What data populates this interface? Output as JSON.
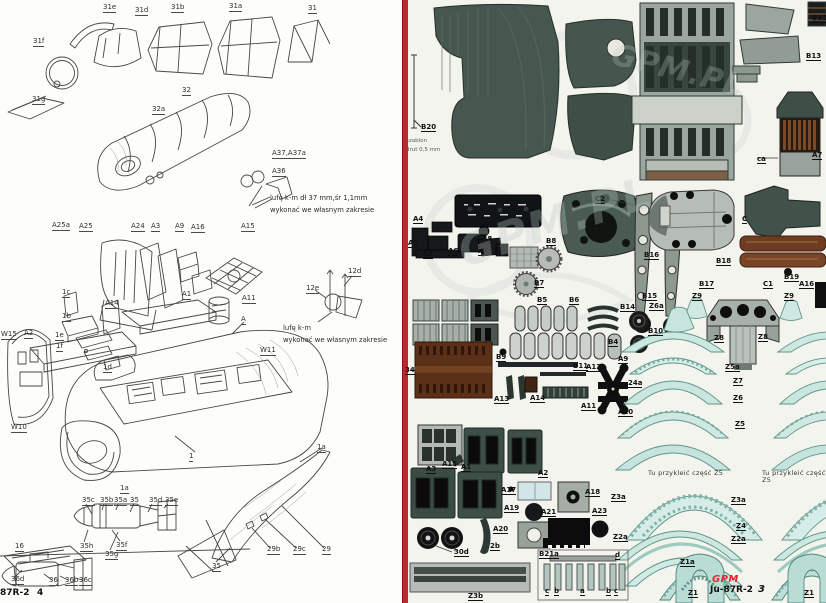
{
  "document": {
    "publisher": "GPM",
    "model": "Ju-87R-2",
    "left_page_number": "4",
    "right_page_number": "3",
    "watermark": "GPM.PL"
  },
  "colors": {
    "divider_red": "#c1272d",
    "dark_green_skin": "#44564e",
    "grey_green_part": "#96a49c",
    "teal_band": "#cde8e1",
    "teal_edge": "#5e9488",
    "brown_part": "#6e3c21",
    "black_part": "#111111",
    "logo_red": "#e02b30"
  },
  "left_labels": [
    {
      "t": "31f",
      "x": 33,
      "y": 38
    },
    {
      "t": "31e",
      "x": 103,
      "y": 4
    },
    {
      "t": "31d",
      "x": 135,
      "y": 7
    },
    {
      "t": "31b",
      "x": 171,
      "y": 4
    },
    {
      "t": "31a",
      "x": 229,
      "y": 3
    },
    {
      "t": "31",
      "x": 308,
      "y": 5
    },
    {
      "t": "31g",
      "x": 32,
      "y": 96
    },
    {
      "t": "32",
      "x": 182,
      "y": 87
    },
    {
      "t": "32a",
      "x": 152,
      "y": 106
    },
    {
      "t": "A37,A37a",
      "x": 272,
      "y": 150
    },
    {
      "t": "A36",
      "x": 272,
      "y": 168
    },
    {
      "t": "A25a",
      "x": 52,
      "y": 222
    },
    {
      "t": "A25",
      "x": 79,
      "y": 223
    },
    {
      "t": "A24",
      "x": 131,
      "y": 223
    },
    {
      "t": "A3",
      "x": 151,
      "y": 223
    },
    {
      "t": "A9",
      "x": 175,
      "y": 223
    },
    {
      "t": "A16",
      "x": 191,
      "y": 224
    },
    {
      "t": "A15",
      "x": 241,
      "y": 223
    },
    {
      "t": "1c",
      "x": 62,
      "y": 289
    },
    {
      "t": "1b",
      "x": 62,
      "y": 313
    },
    {
      "t": "A14",
      "x": 105,
      "y": 300
    },
    {
      "t": "A1",
      "x": 182,
      "y": 291
    },
    {
      "t": "A11",
      "x": 242,
      "y": 295
    },
    {
      "t": "A",
      "x": 241,
      "y": 316
    },
    {
      "t": "12d",
      "x": 348,
      "y": 268
    },
    {
      "t": "12e",
      "x": 306,
      "y": 285
    },
    {
      "t": "W15",
      "x": 1,
      "y": 331
    },
    {
      "t": "A2",
      "x": 24,
      "y": 330
    },
    {
      "t": "1e",
      "x": 55,
      "y": 332
    },
    {
      "t": "1f",
      "x": 56,
      "y": 343
    },
    {
      "t": "1d",
      "x": 103,
      "y": 364
    },
    {
      "t": "W11",
      "x": 260,
      "y": 347
    },
    {
      "t": "W10",
      "x": 11,
      "y": 424
    },
    {
      "t": "1",
      "x": 189,
      "y": 453
    },
    {
      "t": "1a",
      "x": 120,
      "y": 485
    },
    {
      "t": "1a",
      "x": 317,
      "y": 444
    },
    {
      "t": "35c",
      "x": 82,
      "y": 497
    },
    {
      "t": "35b",
      "x": 100,
      "y": 497
    },
    {
      "t": "35a",
      "x": 114,
      "y": 497
    },
    {
      "t": "35",
      "x": 130,
      "y": 497
    },
    {
      "t": "35d",
      "x": 149,
      "y": 497
    },
    {
      "t": "35e",
      "x": 165,
      "y": 497
    },
    {
      "t": "16",
      "x": 15,
      "y": 543
    },
    {
      "t": "35h",
      "x": 80,
      "y": 543
    },
    {
      "t": "35f",
      "x": 116,
      "y": 542
    },
    {
      "t": "35g",
      "x": 105,
      "y": 551
    },
    {
      "t": "29b",
      "x": 267,
      "y": 546
    },
    {
      "t": "29c",
      "x": 293,
      "y": 546
    },
    {
      "t": "29",
      "x": 322,
      "y": 546
    },
    {
      "t": "35",
      "x": 212,
      "y": 563
    },
    {
      "t": "36d",
      "x": 11,
      "y": 576
    },
    {
      "t": "36",
      "x": 49,
      "y": 577
    },
    {
      "t": "36b",
      "x": 65,
      "y": 577
    },
    {
      "t": "36c",
      "x": 79,
      "y": 577
    }
  ],
  "right_labels": [
    {
      "t": "B20",
      "x": 421,
      "y": 124
    },
    {
      "t": "B12",
      "x": 812,
      "y": 15
    },
    {
      "t": "B13",
      "x": 806,
      "y": 53
    },
    {
      "t": "ca",
      "x": 757,
      "y": 156
    },
    {
      "t": "A7",
      "x": 812,
      "y": 152
    },
    {
      "t": "A4",
      "x": 413,
      "y": 216
    },
    {
      "t": "A5",
      "x": 408,
      "y": 240
    },
    {
      "t": "B1",
      "x": 423,
      "y": 251
    },
    {
      "t": "A6",
      "x": 448,
      "y": 248
    },
    {
      "t": "A7",
      "x": 478,
      "y": 248
    },
    {
      "t": "A8",
      "x": 482,
      "y": 236
    },
    {
      "t": "B3",
      "x": 496,
      "y": 247
    },
    {
      "t": "B8",
      "x": 546,
      "y": 238
    },
    {
      "t": "C2",
      "x": 595,
      "y": 196
    },
    {
      "t": "C",
      "x": 742,
      "y": 216
    },
    {
      "t": "B16",
      "x": 644,
      "y": 252
    },
    {
      "t": "B18",
      "x": 716,
      "y": 258
    },
    {
      "t": "B17",
      "x": 699,
      "y": 281
    },
    {
      "t": "B15",
      "x": 642,
      "y": 293
    },
    {
      "t": "B14",
      "x": 620,
      "y": 304
    },
    {
      "t": "B19",
      "x": 784,
      "y": 274
    },
    {
      "t": "C1",
      "x": 763,
      "y": 281
    },
    {
      "t": "A16",
      "x": 799,
      "y": 281
    },
    {
      "t": "Z9",
      "x": 692,
      "y": 293
    },
    {
      "t": "Z9",
      "x": 784,
      "y": 293
    },
    {
      "t": "Z6a",
      "x": 649,
      "y": 303
    },
    {
      "t": "B7",
      "x": 534,
      "y": 280
    },
    {
      "t": "B5",
      "x": 537,
      "y": 297
    },
    {
      "t": "B6",
      "x": 569,
      "y": 297
    },
    {
      "t": "B4",
      "x": 608,
      "y": 339
    },
    {
      "t": "34",
      "x": 405,
      "y": 367
    },
    {
      "t": "B9",
      "x": 496,
      "y": 354
    },
    {
      "t": "B11",
      "x": 573,
      "y": 363
    },
    {
      "t": "A12",
      "x": 586,
      "y": 364
    },
    {
      "t": "A13",
      "x": 494,
      "y": 396
    },
    {
      "t": "A14",
      "x": 530,
      "y": 395
    },
    {
      "t": "A11",
      "x": 581,
      "y": 403
    },
    {
      "t": "A9",
      "x": 618,
      "y": 356
    },
    {
      "t": "24a",
      "x": 628,
      "y": 380
    },
    {
      "t": "A10",
      "x": 618,
      "y": 409
    },
    {
      "t": "B10",
      "x": 648,
      "y": 328
    },
    {
      "t": "Z8",
      "x": 714,
      "y": 335
    },
    {
      "t": "Z8",
      "x": 758,
      "y": 334
    },
    {
      "t": "Z5a",
      "x": 725,
      "y": 364
    },
    {
      "t": "Z7",
      "x": 733,
      "y": 378
    },
    {
      "t": "Z6",
      "x": 733,
      "y": 395
    },
    {
      "t": "Z5",
      "x": 735,
      "y": 421
    },
    {
      "t": "Z3a",
      "x": 611,
      "y": 494
    },
    {
      "t": "Z2a",
      "x": 613,
      "y": 534
    },
    {
      "t": "Z3a",
      "x": 731,
      "y": 497
    },
    {
      "t": "Z4",
      "x": 736,
      "y": 523
    },
    {
      "t": "Z2a",
      "x": 731,
      "y": 536
    },
    {
      "t": "A3",
      "x": 426,
      "y": 466
    },
    {
      "t": "A15",
      "x": 442,
      "y": 461
    },
    {
      "t": "A1",
      "x": 461,
      "y": 464
    },
    {
      "t": "A2",
      "x": 538,
      "y": 470
    },
    {
      "t": "A17",
      "x": 501,
      "y": 487
    },
    {
      "t": "A18",
      "x": 585,
      "y": 489
    },
    {
      "t": "A19",
      "x": 504,
      "y": 505
    },
    {
      "t": "A20",
      "x": 493,
      "y": 526
    },
    {
      "t": "A21",
      "x": 541,
      "y": 509
    },
    {
      "t": "A23",
      "x": 592,
      "y": 508
    },
    {
      "t": "30d",
      "x": 454,
      "y": 549
    },
    {
      "t": "2b",
      "x": 490,
      "y": 543
    },
    {
      "t": "Z3b",
      "x": 468,
      "y": 593
    },
    {
      "t": "B21a",
      "x": 539,
      "y": 551
    },
    {
      "t": "d",
      "x": 615,
      "y": 552
    },
    {
      "t": "c",
      "x": 545,
      "y": 588
    },
    {
      "t": "b",
      "x": 554,
      "y": 588
    },
    {
      "t": "a",
      "x": 580,
      "y": 588
    },
    {
      "t": "b",
      "x": 606,
      "y": 588
    },
    {
      "t": "c",
      "x": 614,
      "y": 588
    },
    {
      "t": "Z1a",
      "x": 680,
      "y": 559
    },
    {
      "t": "Z1",
      "x": 688,
      "y": 590
    },
    {
      "t": "Z1",
      "x": 804,
      "y": 590
    }
  ],
  "texts": [
    {
      "t": "lufę k-m dł 37 mm,śr 1,1mm\nwykonać we własnym zakresie",
      "x": 270,
      "y": 193,
      "cls": "note",
      "n": "gun-barrel-note"
    },
    {
      "t": "lufę k-m\nwykonać we własnym zakresie",
      "x": 283,
      "y": 323,
      "cls": "note",
      "n": "gun-barrel-note-2"
    },
    {
      "t": "szablon\ndrut 0,5 mm",
      "x": 406,
      "y": 137,
      "cls": "tiny",
      "n": "wire-template-note"
    },
    {
      "t": "Tu przykleić część Z5",
      "x": 648,
      "y": 470,
      "cls": "glue",
      "n": "glue-here-band-text"
    },
    {
      "t": "Tu przykleić część Z5",
      "x": 762,
      "y": 470,
      "cls": "glue",
      "n": "glue-here-band-text"
    },
    {
      "t": "87R-2",
      "x": 0,
      "y": 589,
      "cls": "footl",
      "n": "left-page-footer-model"
    },
    {
      "t": "4",
      "x": 37,
      "y": 589,
      "cls": "footl",
      "n": "left-page-number"
    },
    {
      "t": "GPM",
      "x": 712,
      "y": 575,
      "cls": "gpm",
      "n": "publisher-logo"
    },
    {
      "t": "Ju-87R-2",
      "x": 710,
      "y": 586,
      "cls": "footr",
      "n": "right-page-footer-model"
    },
    {
      "t": "3",
      "x": 758,
      "y": 585,
      "cls": "footpg",
      "n": "right-page-number"
    },
    {
      "t": "GPM.PL",
      "x": 455,
      "y": 200,
      "cls": "wm",
      "n": "watermark"
    },
    {
      "t": "GPM.PL",
      "x": 610,
      "y": 55,
      "cls": "wm2",
      "n": "watermark"
    }
  ]
}
